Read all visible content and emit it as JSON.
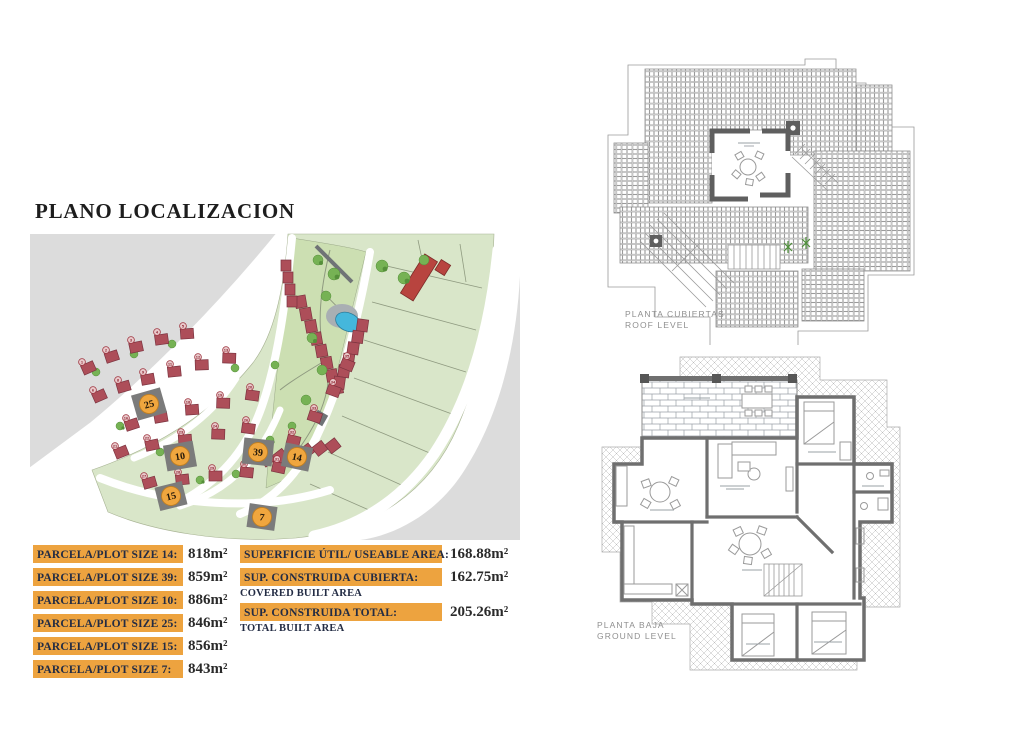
{
  "title": "PLANO LOCALIZACION",
  "tables": {
    "parcels": [
      {
        "label": "PARCELA/PLOT SIZE 14:",
        "value": "818m²"
      },
      {
        "label": "PARCELA/PLOT SIZE 39:",
        "value": "859m²"
      },
      {
        "label": "PARCELA/PLOT SIZE 10:",
        "value": "886m²"
      },
      {
        "label": "PARCELA/PLOT SIZE 25:",
        "value": "846m²"
      },
      {
        "label": "PARCELA/PLOT SIZE 15:",
        "value": "856m²"
      },
      {
        "label": "PARCELA/PLOT SIZE 7:",
        "value": "843m²"
      }
    ],
    "areas": [
      {
        "label": "SUPERFICIE ÚTIL/ USEABLE AREA:",
        "value": "168.88m²",
        "sub": ""
      },
      {
        "label": "SUP. CONSTRUIDA CUBIERTA:",
        "value": "162.75m²",
        "sub": "COVERED BUILT AREA"
      },
      {
        "label": "SUP. CONSTRUIDA TOTAL:",
        "value": "205.26m²",
        "sub": "TOTAL BUILT AREA"
      }
    ]
  },
  "plans": {
    "roof": {
      "l1": "PLANTA CUBIERTAS",
      "l2": "ROOF LEVEL"
    },
    "ground": {
      "l1": "PLANTA BAJA",
      "l2": "GROUND LEVEL"
    }
  },
  "site_plan": {
    "colors": {
      "undeveloped_gray": "#dcdcdc",
      "plot_green": "#d9e6c9",
      "park_green": "#ccdfb2",
      "house_red": "#ad4e59",
      "highlight_gray": "#7b7b7b",
      "marker_orange": "#f0a63e",
      "pool_blue": "#45b7dc",
      "tree_green": "#76b254"
    },
    "highlighted_plots": [
      {
        "number": "25",
        "x": 119,
        "y": 174
      },
      {
        "number": "10",
        "x": 150,
        "y": 226
      },
      {
        "number": "39",
        "x": 228,
        "y": 222
      },
      {
        "number": "14",
        "x": 267,
        "y": 227
      },
      {
        "number": "15",
        "x": 141,
        "y": 266
      },
      {
        "number": "7",
        "x": 232,
        "y": 287
      }
    ],
    "house_markers": [
      {
        "n": "1",
        "x": 52,
        "y": 132,
        "r": -24
      },
      {
        "n": "2",
        "x": 76,
        "y": 120,
        "r": -18
      },
      {
        "n": "3",
        "x": 101,
        "y": 110,
        "r": -12
      },
      {
        "n": "4",
        "x": 127,
        "y": 102,
        "r": -8
      },
      {
        "n": "5",
        "x": 153,
        "y": 96,
        "r": -4
      },
      {
        "n": "6",
        "x": 63,
        "y": 160,
        "r": -24
      },
      {
        "n": "8",
        "x": 88,
        "y": 150,
        "r": -16
      },
      {
        "n": "9",
        "x": 113,
        "y": 142,
        "r": -10
      },
      {
        "n": "11",
        "x": 140,
        "y": 134,
        "r": -6
      },
      {
        "n": "12",
        "x": 168,
        "y": 127,
        "r": -2
      },
      {
        "n": "13",
        "x": 196,
        "y": 120,
        "r": 2
      },
      {
        "n": "16",
        "x": 96,
        "y": 188,
        "r": -18
      },
      {
        "n": "17",
        "x": 126,
        "y": 180,
        "r": -10
      },
      {
        "n": "18",
        "x": 158,
        "y": 172,
        "r": -4
      },
      {
        "n": "19",
        "x": 190,
        "y": 165,
        "r": 2
      },
      {
        "n": "20",
        "x": 220,
        "y": 157,
        "r": 8
      },
      {
        "n": "21",
        "x": 85,
        "y": 216,
        "r": -22
      },
      {
        "n": "22",
        "x": 117,
        "y": 208,
        "r": -12
      },
      {
        "n": "23",
        "x": 151,
        "y": 202,
        "r": -4
      },
      {
        "n": "24",
        "x": 185,
        "y": 196,
        "r": 2
      },
      {
        "n": "26",
        "x": 216,
        "y": 190,
        "r": 8
      },
      {
        "n": "27",
        "x": 114,
        "y": 246,
        "r": -16
      },
      {
        "n": "28",
        "x": 148,
        "y": 242,
        "r": -6
      },
      {
        "n": "29",
        "x": 182,
        "y": 238,
        "r": 0
      },
      {
        "n": "30",
        "x": 214,
        "y": 234,
        "r": 6
      },
      {
        "n": "31",
        "x": 247,
        "y": 229,
        "r": 12
      },
      {
        "n": "32",
        "x": 262,
        "y": 202,
        "r": 14
      },
      {
        "n": "33",
        "x": 284,
        "y": 178,
        "r": 18
      },
      {
        "n": "34",
        "x": 303,
        "y": 152,
        "r": 20
      },
      {
        "n": "35",
        "x": 317,
        "y": 126,
        "r": 22
      }
    ]
  }
}
